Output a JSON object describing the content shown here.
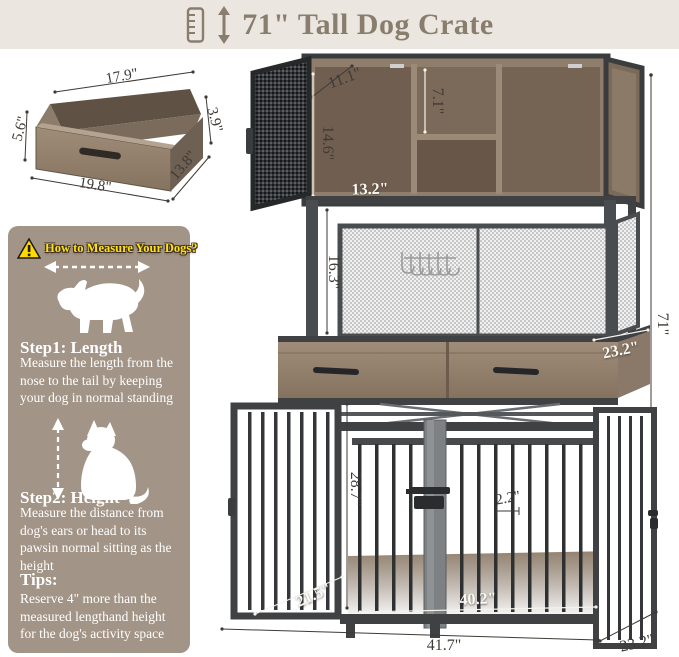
{
  "header": {
    "title": "71\" Tall Dog Crate"
  },
  "drawer_diagram": {
    "width_top": "17.9\"",
    "height_left": "5.6\"",
    "width_bottom": "19.8\"",
    "depth": "13.8\"",
    "height_right": "3.9\""
  },
  "sidebar": {
    "title": "How to Measure Your Dogs?",
    "step1": {
      "heading": "Step1: Length",
      "text": "Measure the length from the nose to the tail by keeping your dog in normal standing"
    },
    "step2": {
      "heading": "Step2: Height",
      "text": "Measure the distance from dog's ears or head to its pawsin normal sitting as the height"
    },
    "tips": {
      "heading": "Tips:",
      "text": "Reserve 4\" more than the measured lengthand height for the dog's activity space"
    }
  },
  "dimensions": {
    "top_door_depth": "11.1\"",
    "top_cabinet_height": "14.6\"",
    "top_shelf_height": "7.1\"",
    "top_cabinet_width": "13.2\"",
    "mesh_section_height": "16.3\"",
    "drawer_section_depth": "23.2\"",
    "overall_height": "71\"",
    "crate_inner_height": "28.7\"",
    "bar_spacing": "2.2\"",
    "crate_floor_depth": "21.5\"",
    "crate_inner_width": "40.2\"",
    "overall_width": "41.7\"",
    "overall_depth": "23.2\""
  },
  "colors": {
    "header_bg": "#ebe7e0",
    "title_text": "#897d6d",
    "sidebar_bg": "#a29486",
    "accent_yellow": "#ffe11a",
    "wood": "#8f7e6c",
    "metal": "#3f4143"
  }
}
